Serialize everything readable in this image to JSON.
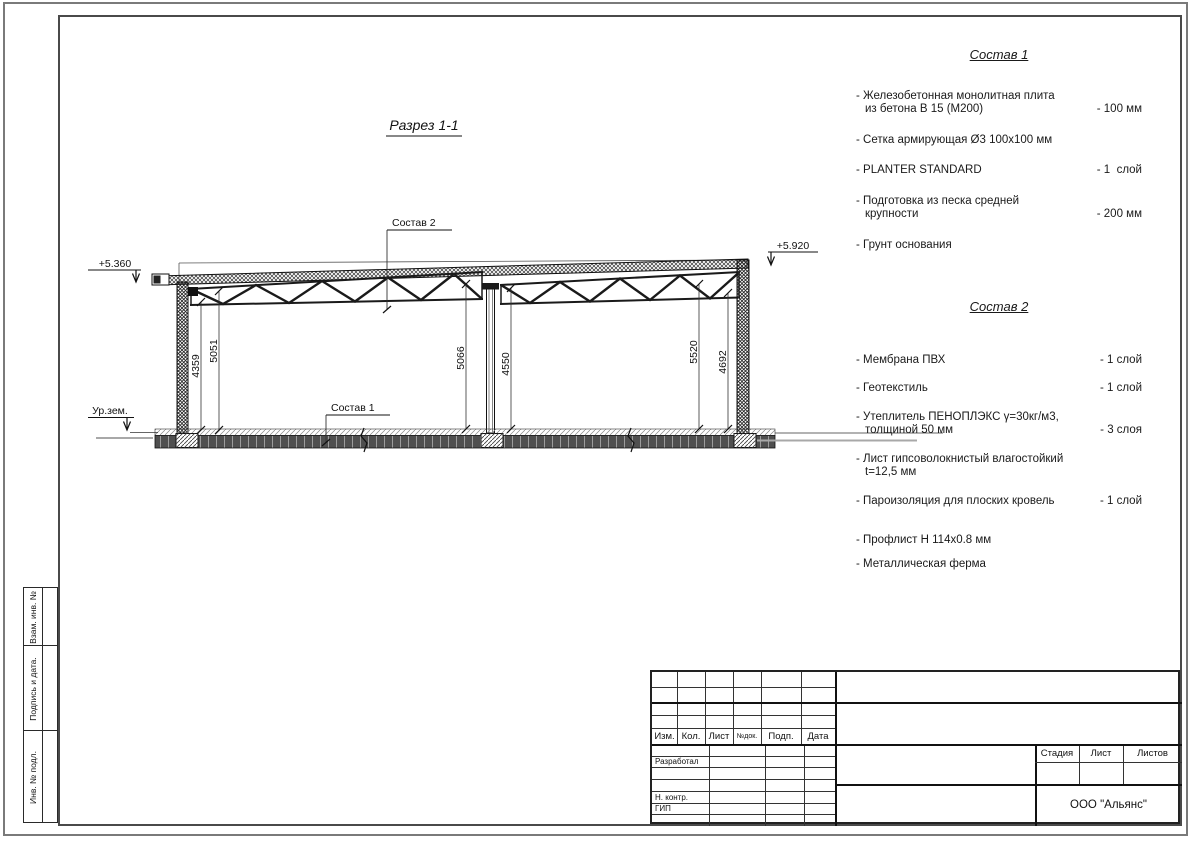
{
  "drawing": {
    "title": "Разрез 1-1",
    "elevation_left": "+5.360",
    "elevation_right": "+5.920",
    "ground_label": "Ур.зем.",
    "leader_roof": "Состав 2",
    "leader_floor": "Состав 1",
    "dimensions": [
      "4359",
      "5051",
      "5066",
      "4550",
      "5520",
      "4692"
    ]
  },
  "sostav1": {
    "title": "Состав 1",
    "items": [
      {
        "name": "- Железобетонная  монолитная плита\nиз бетона В 15 (М200)",
        "value": "- 100 мм"
      },
      {
        "name": "- Сетка армирующая Ø3 100х100 мм",
        "value": ""
      },
      {
        "name": "- PLANTER STANDARD",
        "value": "- 1  слой"
      },
      {
        "name": "- Подготовка из песка средней\nкрупности",
        "value": "- 200 мм"
      },
      {
        "name": "- Грунт основания",
        "value": ""
      }
    ]
  },
  "sostav2": {
    "title": "Состав 2",
    "items": [
      {
        "name": "- Мембрана ПВХ",
        "value": "- 1 слой"
      },
      {
        "name": "- Геотекстиль",
        "value": "- 1 слой"
      },
      {
        "name": "- Утеплитель ПЕНОПЛЭКС γ=30кг/м3,\nтолщиной 50 мм",
        "value": "- 3 слоя"
      },
      {
        "name": "- Лист гипсоволокнистый влагостойкий\nt=12,5 мм",
        "value": ""
      },
      {
        "name": "- Пароизоляция для плоских кровель",
        "value": "- 1 слой"
      },
      {
        "name": "- Профлист Н 114х0.8 мм",
        "value": ""
      },
      {
        "name": "- Металлическая ферма",
        "value": ""
      }
    ]
  },
  "titleblock": {
    "header_cols": [
      "Изм.",
      "Кол.",
      "Лист",
      "№док.",
      "Подп.",
      "Дата"
    ],
    "role_rows": [
      "Разработал",
      "Н. контр.",
      "ГИП"
    ],
    "stage_cols": [
      "Стадия",
      "Лист",
      "Листов"
    ],
    "company": "ООО \"Альянс\""
  },
  "side_strip": {
    "labels": [
      "Взам. инв. №",
      "Подпись и дата.",
      "Инв. № подл."
    ]
  }
}
